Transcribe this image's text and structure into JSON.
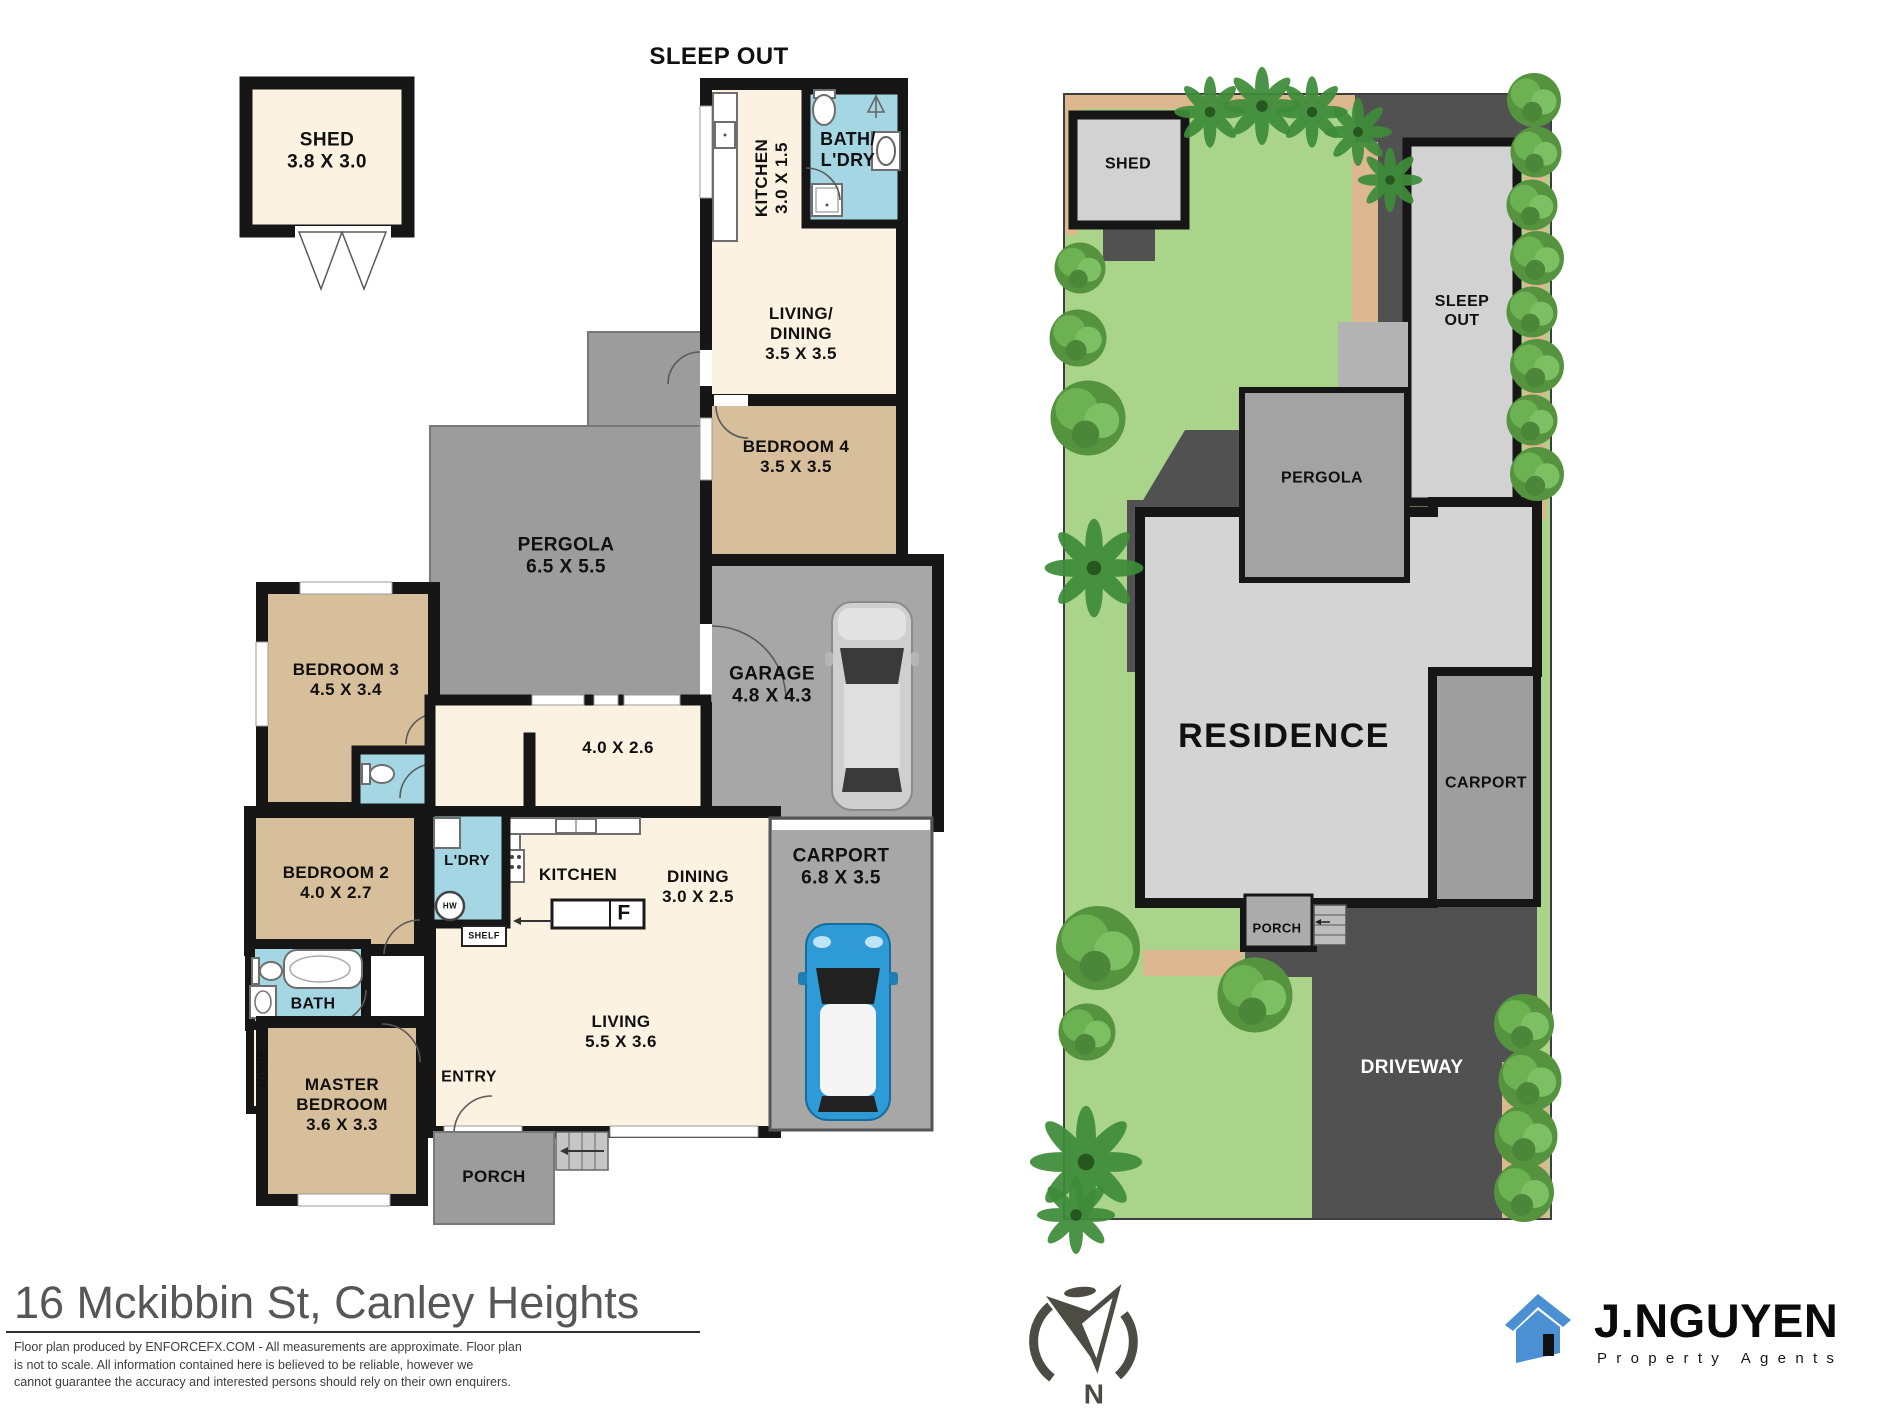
{
  "colors": {
    "wall": "#161616",
    "cream": "#FBF2E2",
    "tan": "#D8BF9B",
    "wet": "#A4D7E3",
    "gray": "#A7A7A7",
    "pgray": "#9C9C9C",
    "lawn": "#A9D48A",
    "pav": "#515151",
    "res": "#D4D4D4",
    "path": "#DDB790",
    "bld": "#D2D2D2",
    "car_blue": "#2E9BD6",
    "logo_blue": "#4B90D3",
    "compass": "#4C4C45"
  },
  "floor_plan": {
    "title": "SLEEP OUT",
    "rooms": {
      "shed": [
        "SHED",
        "3.8 X 3.0"
      ],
      "sleepout_kitchen": [
        "KITCHEN",
        "3.0 X 1.5"
      ],
      "sleepout_bath": [
        "BATH/",
        "L'DRY"
      ],
      "sleepout_living": [
        "LIVING/",
        "DINING",
        "3.5 X 3.5"
      ],
      "bedroom4": [
        "BEDROOM 4",
        "3.5 X 3.5"
      ],
      "pergola": [
        "PERGOLA",
        "6.5 X 5.5"
      ],
      "garage": [
        "GARAGE",
        "4.8 X 4.3"
      ],
      "bedroom3": [
        "BEDROOM 3",
        "4.5 X 3.4"
      ],
      "family": [
        "4.0 X 2.6"
      ],
      "carport": [
        "CARPORT",
        "6.8 X 3.5"
      ],
      "bedroom2": [
        "BEDROOM 2",
        "4.0 X 2.7"
      ],
      "laundry": [
        "L'DRY"
      ],
      "kitchen": [
        "KITCHEN"
      ],
      "dining": [
        "DINING",
        "3.0 X 2.5"
      ],
      "living": [
        "LIVING",
        "5.5 X 3.6"
      ],
      "bath": [
        "BATH"
      ],
      "robe": [
        "ROBE"
      ],
      "master": [
        "MASTER",
        "BEDROOM",
        "3.6 X 3.3"
      ],
      "entry": [
        "ENTRY"
      ],
      "porch": [
        "PORCH"
      ]
    },
    "fixtures": {
      "shelf": "SHELF",
      "fridge": "F",
      "hot_water": "HW"
    }
  },
  "site_plan": {
    "shed": [
      "SHED"
    ],
    "sleep_out": [
      "SLEEP",
      "OUT"
    ],
    "pergola": [
      "PERGOLA"
    ],
    "residence": [
      "RESIDENCE"
    ],
    "carport": [
      "CARPORT"
    ],
    "porch": [
      "PORCH"
    ],
    "driveway": [
      "DRIVEWAY"
    ]
  },
  "footer": {
    "address": "16 Mckibbin St, Canley Heights",
    "disclaimer": [
      "Floor plan produced by ENFORCEFX.COM - All  measurements are approximate. Floor plan",
      "is not to scale. All information contained here is believed to be reliable, however we",
      "cannot guarantee the accuracy and interested persons should rely on their own enquirers."
    ],
    "compass_n": "N",
    "logo_name": "J.NGUYEN",
    "logo_sub": "Property Agents"
  }
}
